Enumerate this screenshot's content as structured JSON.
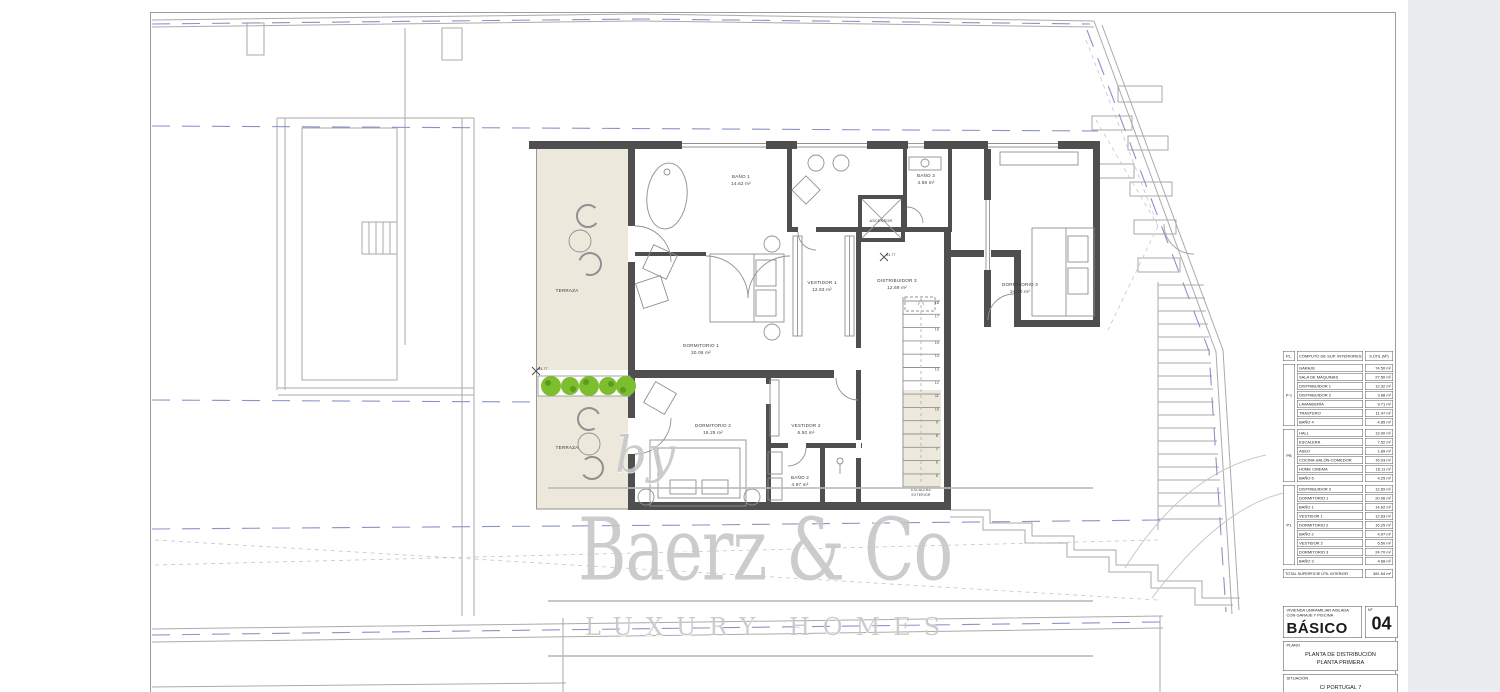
{
  "watermark": {
    "by": "by",
    "brand": "Baerz & Co",
    "tagline": "LUXURY HOMES"
  },
  "plan": {
    "labels": {
      "terraza_upper": "TERRAZA",
      "terraza_lower": "TERRAZA",
      "bano1": {
        "name": "BAÑO 1",
        "area": "14.62 m²"
      },
      "bano3": {
        "name": "BAÑO 3",
        "area": "4.68 m²"
      },
      "ascensor": "ASCENSOR",
      "vestidor1": {
        "name": "VESTIDOR 1",
        "area": "12.83 m²"
      },
      "distribuidor3": {
        "name": "DISTRIBUIDOR 3",
        "area": "12.69 m²"
      },
      "dormitorio3": {
        "name": "DORMITORIO 3",
        "area": "24.70 m²"
      },
      "dormitorio1": {
        "name": "DORMITORIO 1",
        "area": "20.06 m²"
      },
      "dormitorio2": {
        "name": "DORMITORIO 2",
        "area": "16.25 m²"
      },
      "vestidor2": {
        "name": "VESTIDOR 2",
        "area": "6.50 m²"
      },
      "bano2": {
        "name": "BAÑO 2",
        "area": "4.97 m²"
      },
      "escalera_exterior": {
        "line1": "ESCALERA",
        "line2": "EXTERIOR"
      }
    },
    "markers": [
      "34.77",
      "34.77"
    ],
    "stair_numbers": [
      "18",
      "17",
      "16",
      "15",
      "14",
      "13",
      "12",
      "11",
      "10",
      "9",
      "8",
      "7",
      "6",
      "5"
    ]
  },
  "table": {
    "header": {
      "pl": "PL.",
      "title": "CÓMPUTO DE SUP. INTERIORES",
      "sutil": "S.ÚTIL (M²)"
    },
    "groups": [
      {
        "label": "P-1",
        "rows": [
          {
            "name": "GARAJE",
            "area": "74.50 m²"
          },
          {
            "name": "SALA DE MÁQUINAS",
            "area": "27.50 m²"
          },
          {
            "name": "DISTRIBUIDOR 1",
            "area": "12.32 m²"
          },
          {
            "name": "DISTRIBUIDOR 2",
            "area": "3.88 m²"
          },
          {
            "name": "LAVANDERÍA",
            "area": "9.71 m²"
          },
          {
            "name": "TRASTERO",
            "area": "11.47 m²"
          },
          {
            "name": "BAÑO 4",
            "area": "4.85 m²"
          }
        ]
      },
      {
        "label": "PB",
        "rows": [
          {
            "name": "HALL",
            "area": "13.00 m²"
          },
          {
            "name": "ESCALERA",
            "area": "7.52 m²"
          },
          {
            "name": "ASEO",
            "area": "1.89 m²"
          },
          {
            "name": "COCINA-SALÓN-COMEDOR",
            "area": "76.03 m²"
          },
          {
            "name": "HOME CINEMA",
            "area": "16.11 m²"
          },
          {
            "name": "BAÑO 5",
            "area": "4.25 m²"
          }
        ]
      },
      {
        "label": "P1",
        "rows": [
          {
            "name": "DISTRIBUIDOR 3",
            "area": "12.69 m²"
          },
          {
            "name": "DORMITORIO 1",
            "area": "20.06 m²"
          },
          {
            "name": "BAÑO 1",
            "area": "14.62 m²"
          },
          {
            "name": "VESTIDOR 1",
            "area": "12.83 m²"
          },
          {
            "name": "DORMITORIO 2",
            "area": "16.25 m²"
          },
          {
            "name": "BAÑO 2",
            "area": "4.97 m²"
          },
          {
            "name": "VESTIDOR 2",
            "area": "6.50 m²"
          },
          {
            "name": "DORMITORIO 3",
            "area": "24.70 m²"
          },
          {
            "name": "BAÑO 3",
            "area": "4.68 m²"
          }
        ]
      }
    ],
    "total": {
      "name": "TOTAL SUPERFICIE ÚTIL INTERIOR",
      "area": "381.54 m²"
    }
  },
  "title_block": {
    "project_line1": "VIVIENDA UNIFAMILIAR AISLADA",
    "project_line2": "CON GARAJE Y PISCINA",
    "doc_type": "BÁSICO",
    "number_label": "Nº",
    "number": "04",
    "plano_label": "PLANO",
    "plano_line1": "PLANTA DE DISTRIBUCIÓN",
    "plano_line2": "PLANTA PRIMERA",
    "situacion_label": "SITUACIÓN",
    "situacion_value": "C/ PORTUGAL 7"
  }
}
